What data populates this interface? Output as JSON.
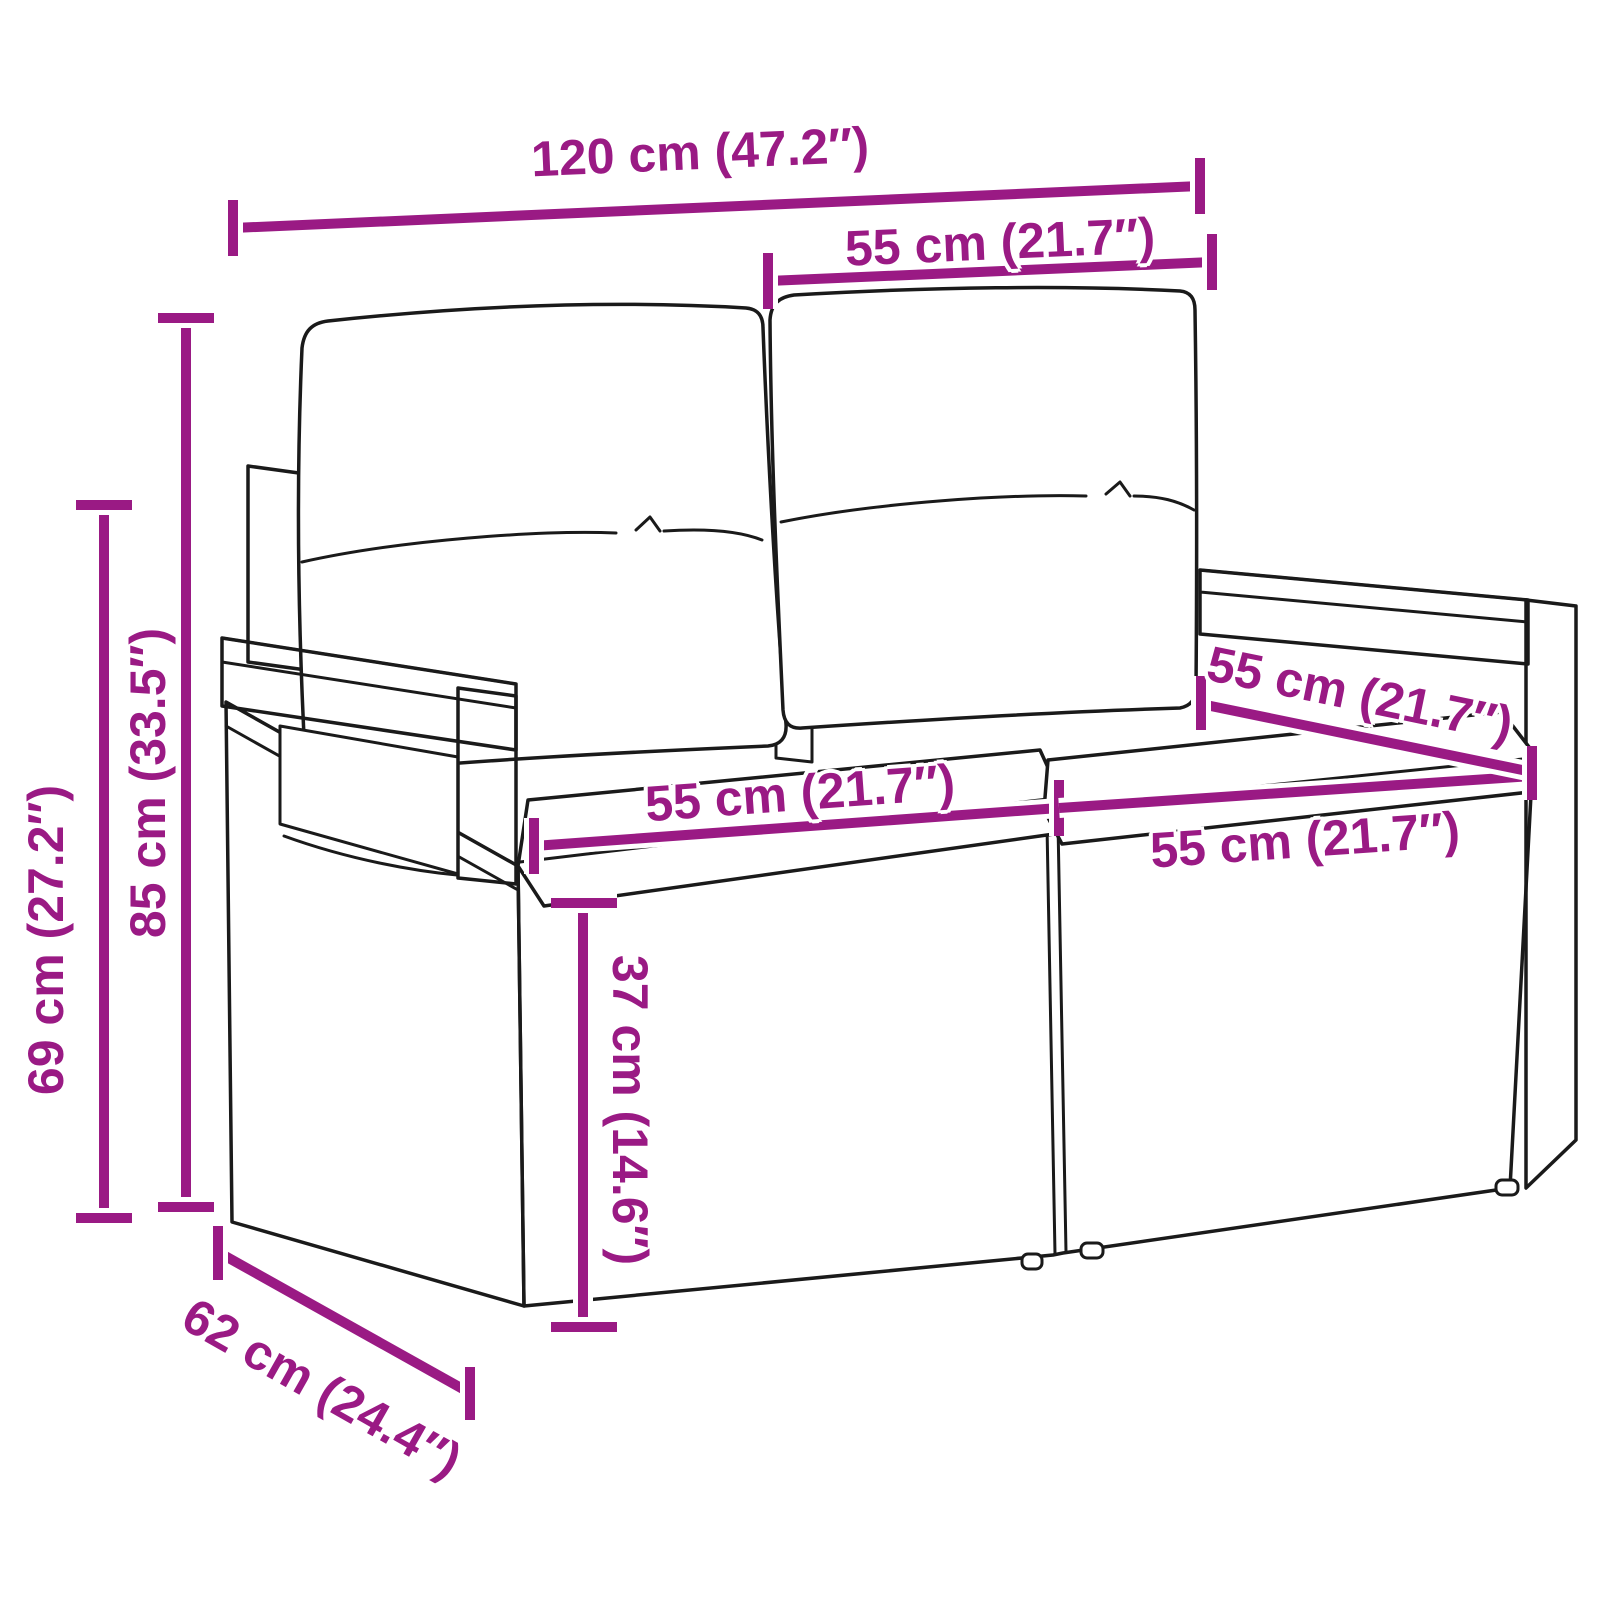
{
  "colors": {
    "accent": "#9A1A84",
    "line": "#1A1A1A",
    "background": "#FFFFFF"
  },
  "illustration": {
    "name": "poly-rattan-two-seater-garden-sofa-with-cushions-icon"
  },
  "dimensions": [
    {
      "id": "overall-width",
      "label": "120 cm (47.2″)"
    },
    {
      "id": "module-width-top",
      "label": "55 cm (21.7″)"
    },
    {
      "id": "overall-height",
      "label": "85 cm (33.5″)"
    },
    {
      "id": "armrest-height",
      "label": "69 cm (27.2″)"
    },
    {
      "id": "seat-width-left",
      "label": "55 cm (21.7″)"
    },
    {
      "id": "seat-depth",
      "label": "55 cm (21.7″)"
    },
    {
      "id": "seat-width-right",
      "label": "55 cm (21.7″)"
    },
    {
      "id": "seat-height",
      "label": "37 cm (14.6″)"
    },
    {
      "id": "overall-depth",
      "label": "62 cm (24.4″)"
    }
  ]
}
